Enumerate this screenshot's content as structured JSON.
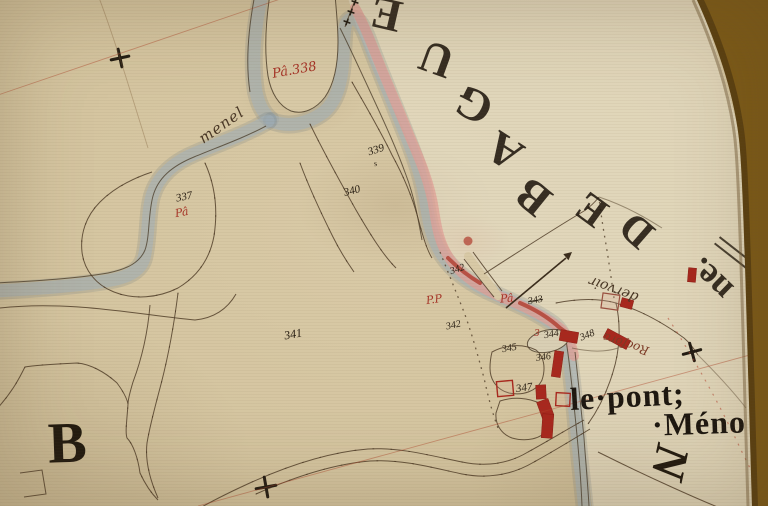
{
  "colors": {
    "paper": "#d6c6a2",
    "stream_blue": "#a9b8c1",
    "boundary_pink": "#dfa09a",
    "ink_red": "#a63326",
    "ink_dark": "#2a2014",
    "mount_brown": "#7c5a17"
  },
  "section_letter": "B",
  "hamlet_name": {
    "line1": "le·pont;",
    "line2": "·Méno"
  },
  "compass_letter": "N",
  "arc_letters": [
    {
      "ch": "E"
    },
    {
      "ch": "U"
    },
    {
      "ch": "G"
    },
    {
      "ch": "A"
    },
    {
      "ch": "B"
    },
    {
      "ch": "E"
    },
    {
      "ch": "D"
    },
    {
      "ch": "ne."
    }
  ],
  "parcel_numbers": [
    {
      "n": "337"
    },
    {
      "n": "339"
    },
    {
      "n": "340"
    },
    {
      "n": "341"
    },
    {
      "n": "342"
    },
    {
      "n": "342"
    },
    {
      "n": "343"
    },
    {
      "n": "344"
    },
    {
      "n": "345"
    },
    {
      "n": "346"
    },
    {
      "n": "347"
    },
    {
      "n": "348"
    }
  ],
  "landuse_marks": [
    {
      "t": "Pâ.338"
    },
    {
      "t": "Pâ"
    },
    {
      "t": "Pâ"
    },
    {
      "t": "P.P"
    },
    {
      "t": "3"
    },
    {
      "t": "s"
    }
  ],
  "annotations": [
    {
      "t": "menel"
    },
    {
      "t": "dervoir"
    },
    {
      "t": "Rocfora"
    }
  ]
}
